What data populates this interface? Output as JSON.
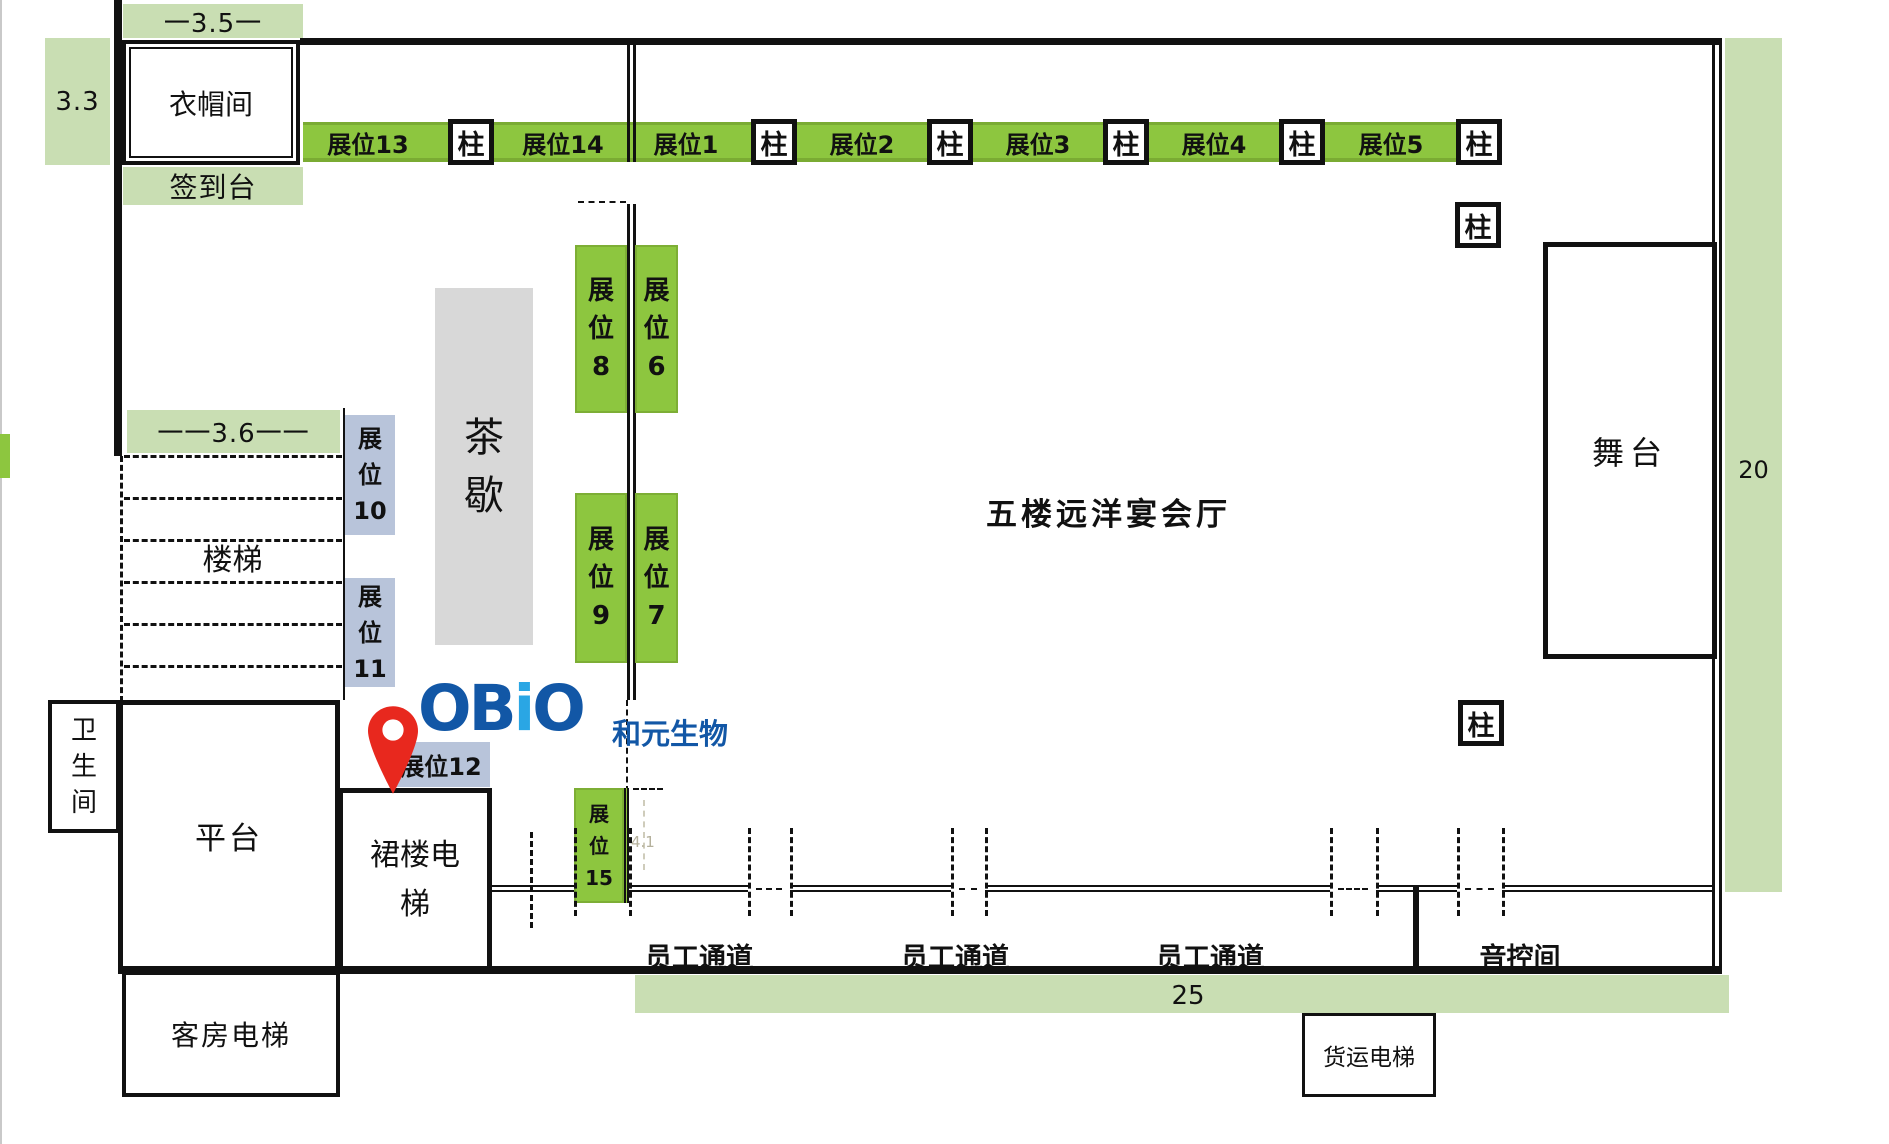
{
  "title": "五楼远洋宴会厅平面图",
  "colors": {
    "booth_green": "#8dc63f",
    "dim_green": "#c9deb3",
    "booth_blue": "#b8c4da",
    "tea_gray": "#d8d8d8",
    "wall_black": "#111111",
    "logo_dark_blue": "#1257a6",
    "logo_light_blue": "#2aa6e4",
    "pin_red": "#e8281e"
  },
  "dims": {
    "top_width": "一3.5一",
    "left_height": "3.3",
    "stair_width": "一一3.6一一",
    "right_height": "20",
    "bottom_width": "25",
    "booth15_width": "4.1"
  },
  "rooms": {
    "cloakroom": "衣帽间",
    "signin": "签到台",
    "hall": "五楼远洋宴会厅",
    "stage": "舞台",
    "stairs": "楼梯",
    "tea": [
      "茶",
      "歇"
    ],
    "toilet": [
      "卫",
      "生",
      "间"
    ],
    "platform": "平台",
    "podium_elevator": [
      "裙楼电",
      "梯"
    ],
    "guest_elevator": "客房电梯",
    "freight_elevator": "货运电梯",
    "sound_room": "音控间",
    "staff_passage": "员工通道"
  },
  "booth12": {
    "label": "展位12"
  },
  "logo": {
    "word": [
      {
        "ch": "O",
        "c": "dark"
      },
      {
        "ch": "B",
        "c": "dark"
      },
      {
        "ch": "i",
        "c": "light"
      },
      {
        "ch": "O",
        "c": "dark"
      }
    ],
    "cn": "和元生物"
  },
  "strip": {
    "x": 303,
    "y": 122,
    "w": 1165,
    "h": 40,
    "items": [
      {
        "t": "booth",
        "label": "展位13",
        "cx": 368
      },
      {
        "t": "pillar",
        "label": "柱",
        "cx": 471
      },
      {
        "t": "booth",
        "label": "展位14",
        "cx": 563
      },
      {
        "t": "booth",
        "label": "展位1",
        "cx": 686
      },
      {
        "t": "pillar",
        "label": "柱",
        "cx": 774
      },
      {
        "t": "booth",
        "label": "展位2",
        "cx": 862
      },
      {
        "t": "pillar",
        "label": "柱",
        "cx": 950
      },
      {
        "t": "booth",
        "label": "展位3",
        "cx": 1038
      },
      {
        "t": "pillar",
        "label": "柱",
        "cx": 1126
      },
      {
        "t": "booth",
        "label": "展位4",
        "cx": 1214
      },
      {
        "t": "pillar",
        "label": "柱",
        "cx": 1302
      },
      {
        "t": "booth",
        "label": "展位5",
        "cx": 1391
      },
      {
        "t": "pillar",
        "label": "柱",
        "cx": 1479
      }
    ]
  },
  "free_pillars": [
    {
      "label": "柱",
      "x": 1455,
      "y": 202
    },
    {
      "label": "柱",
      "x": 1458,
      "y": 700
    }
  ],
  "island_booths": [
    {
      "id": "booth-8",
      "chars": [
        "展",
        "位",
        "8"
      ],
      "x": 575,
      "y": 245,
      "w": 52,
      "h": 168,
      "color": "green",
      "fs": 26
    },
    {
      "id": "booth-6",
      "chars": [
        "展",
        "位",
        "6"
      ],
      "x": 635,
      "y": 245,
      "w": 43,
      "h": 168,
      "color": "green",
      "fs": 26
    },
    {
      "id": "booth-9",
      "chars": [
        "展",
        "位",
        "9"
      ],
      "x": 575,
      "y": 493,
      "w": 52,
      "h": 170,
      "color": "green",
      "fs": 26
    },
    {
      "id": "booth-7",
      "chars": [
        "展",
        "位",
        "7"
      ],
      "x": 635,
      "y": 493,
      "w": 43,
      "h": 170,
      "color": "green",
      "fs": 26
    },
    {
      "id": "booth-10",
      "chars": [
        "展",
        "位",
        "10"
      ],
      "x": 345,
      "y": 415,
      "w": 50,
      "h": 120,
      "color": "blue",
      "fs": 24
    },
    {
      "id": "booth-11",
      "chars": [
        "展",
        "位",
        "11"
      ],
      "x": 345,
      "y": 578,
      "w": 50,
      "h": 109,
      "color": "blue",
      "fs": 24
    },
    {
      "id": "booth-15",
      "chars": [
        "展",
        "位",
        "15"
      ],
      "x": 574,
      "y": 788,
      "w": 55,
      "h": 115,
      "color": "green",
      "fs": 20,
      "wallRight": true
    }
  ],
  "stairs": {
    "lines_y": [
      455,
      497,
      539,
      581,
      623,
      665
    ],
    "x": 124,
    "w": 218
  },
  "corridor": {
    "wall_y": 885,
    "segments": [
      [
        492,
        574
      ],
      [
        629,
        748
      ],
      [
        790,
        951
      ],
      [
        985,
        1330
      ],
      [
        1376,
        1413
      ],
      [
        1419,
        1457
      ],
      [
        1502,
        1712
      ]
    ],
    "door_dashes": [
      [
        756,
        782
      ],
      [
        959,
        977
      ],
      [
        1338,
        1368
      ],
      [
        1465,
        1494
      ]
    ],
    "vlines": [
      [
        530,
        832,
        96
      ],
      [
        574,
        828,
        88
      ],
      [
        629,
        828,
        88
      ],
      [
        748,
        828,
        88
      ],
      [
        790,
        828,
        88
      ],
      [
        951,
        828,
        88
      ],
      [
        985,
        828,
        88
      ],
      [
        1330,
        828,
        88
      ],
      [
        1376,
        828,
        88
      ],
      [
        1457,
        828,
        88
      ],
      [
        1502,
        828,
        88
      ]
    ],
    "passage_centers": [
      699,
      955,
      1210
    ]
  }
}
